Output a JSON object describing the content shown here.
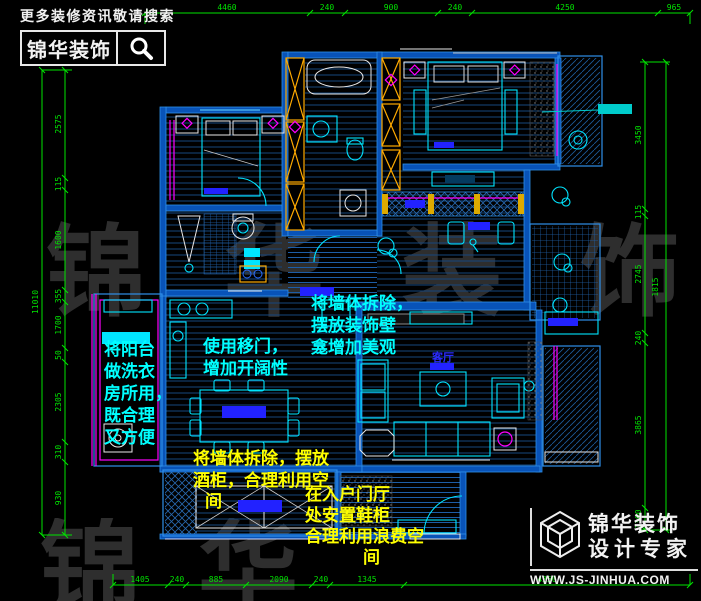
{
  "branding_top": {
    "tagline": "更多装修资讯敬请搜索",
    "logo_text": "锦华装饰"
  },
  "branding_bottom": {
    "company": "锦华装饰",
    "subtitle": "设计专家",
    "url": "WWW.JS-JINHUA.COM"
  },
  "watermark": {
    "row1": "锦华装饰",
    "row2": "锦华装饰"
  },
  "room_labels": {
    "living": "客厅"
  },
  "notes": {
    "niche": {
      "color": "#00ffff",
      "lines": [
        "将墙体拆除，",
        "摆放装饰壁",
        "龛增加美观"
      ]
    },
    "sliding_door": {
      "color": "#00ffff",
      "lines": [
        "使用移门，",
        "增加开阔性"
      ]
    },
    "laundry_balcony": {
      "color": "#00ffff",
      "lines": [
        "将阳台",
        "做洗衣",
        "房所用，",
        "既合理",
        "又方便"
      ]
    },
    "wine_cabinet": {
      "color": "#ffff00",
      "lines": [
        "将墙体拆除，摆放",
        "酒柜，合理利用空",
        "间"
      ]
    },
    "shoe_cabinet": {
      "color": "#ffff00",
      "lines": [
        "在入户门厅",
        "处安置鞋柜",
        "合理利用浪费空",
        "间"
      ]
    }
  },
  "dimensions": {
    "top": [
      "4460",
      "240",
      "900",
      "240",
      "4250",
      "965"
    ],
    "bottom": [
      "1405",
      "240",
      "885",
      "2090",
      "240",
      "1345",
      "4350"
    ],
    "left": [
      "2575",
      "115",
      "1600",
      "355",
      "1700",
      "50",
      "2305",
      "310",
      "930"
    ],
    "left_total": "11010",
    "right": [
      "3450",
      "115",
      "2745",
      "240",
      "3865",
      "1300"
    ],
    "right_extra": "1815"
  },
  "colors": {
    "wall_blue": "#0853b8",
    "fixture_cyan": "#00e5ff",
    "dimension_green": "#00e400",
    "accent_magenta": "#ff00ff",
    "accent_yellow": "#ffaa00",
    "note_cyan": "#00ffff",
    "note_yellow": "#ffff00",
    "label_blue": "#2222ff"
  }
}
